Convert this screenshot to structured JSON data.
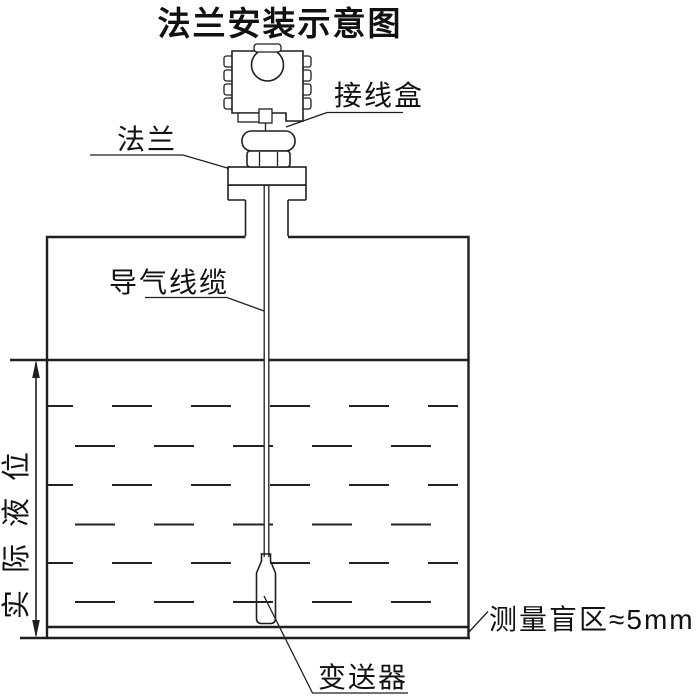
{
  "title": "法兰安装示意图",
  "labels": {
    "junction_box": "接线盒",
    "flange": "法兰",
    "air_cable": "导气线缆",
    "actual_level": "实际液位",
    "transmitter": "变送器",
    "blind_zone": "测量盲区≈5mm"
  },
  "colors": {
    "background": "#ffffff",
    "line": "#1f1f1f",
    "text": "#111111"
  }
}
